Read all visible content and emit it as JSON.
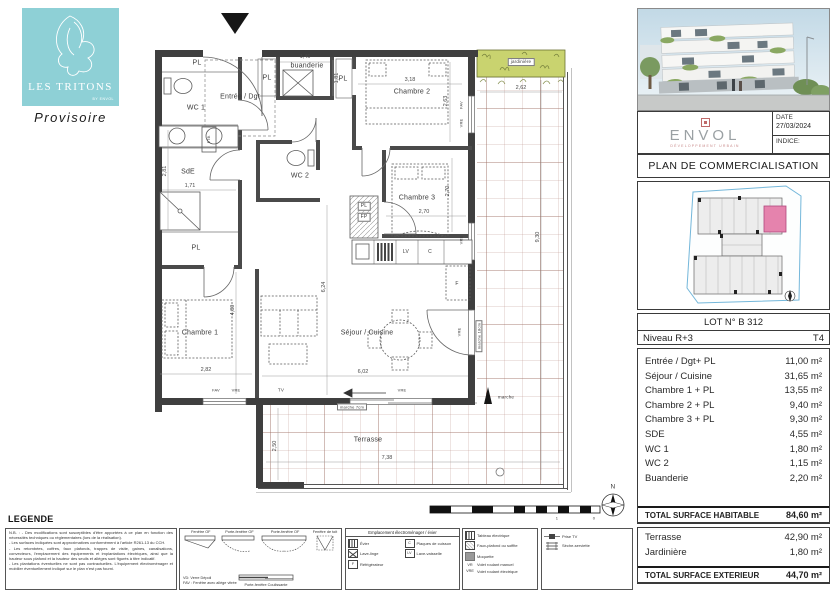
{
  "logo": {
    "title": "LES TRITONS",
    "subtitle": "BY ENVOL",
    "status": "Provisoire"
  },
  "header": {
    "developer_name": "ENVOL",
    "developer_tagline": "DÉVELOPPEMENT URBAIN",
    "date_label": "DATE",
    "date_value": "27/03/2024",
    "indice_label": "INDICE:",
    "doc_title": "PLAN DE COMMERCIALISATION"
  },
  "lot": {
    "number": "LOT N° B 312",
    "level": "Niveau R+3",
    "type": "T4"
  },
  "surfaces": {
    "rooms": [
      {
        "name": "Entrée / Dgt+ PL",
        "area": "11,00 m²"
      },
      {
        "name": "Séjour / Cuisine",
        "area": "31,65 m²"
      },
      {
        "name": "Chambre 1 + PL",
        "area": "13,55 m²"
      },
      {
        "name": "Chambre 2 + PL",
        "area": "9,40 m²"
      },
      {
        "name": "Chambre 3 + PL",
        "area": "9,30 m²"
      },
      {
        "name": "SDE",
        "area": "4,55 m²"
      },
      {
        "name": "WC 1",
        "area": "1,80 m²"
      },
      {
        "name": "WC 2",
        "area": "1,15 m²"
      },
      {
        "name": "Buanderie",
        "area": "2,20 m²"
      }
    ],
    "total_habitable_label": "TOTAL SURFACE HABITABLE",
    "total_habitable_value": "84,60 m²",
    "exterior": [
      {
        "name": "Terrasse",
        "area": "42,90 m²"
      },
      {
        "name": "Jardinière",
        "area": "1,80 m²"
      }
    ],
    "total_exterior_label": "TOTAL SURFACE EXTERIEUR",
    "total_exterior_value": "44,70 m²"
  },
  "plan": {
    "labels": {
      "pl": "PL",
      "fp": "FP",
      "wc1": "WC 1",
      "wc2": "WC 2",
      "sde": "SdE",
      "entree": "Entrée / Dgt",
      "buanderie": "buanderie",
      "chambre1": "Chambre 1",
      "chambre2": "Chambre 2",
      "chambre3": "Chambre 3",
      "sejour": "Séjour / Cuisine",
      "terrasse": "Terrasse",
      "jardiniere": "jardinière",
      "etb": "ETB.",
      "tv": "TV",
      "lv": "LV",
      "c": "C",
      "f": "F",
      "vre": "VRE",
      "fav": "FAV",
      "marche7": "marche 7cm",
      "marche18": "marche 18cm",
      "marche": "marche"
    },
    "dims": {
      "buanderie_w": "1,46",
      "buanderie_h": "1,81",
      "ch2_w": "3,18",
      "ch2_h": "2,63",
      "ch3_w": "2,70",
      "ch3_h": "2,70",
      "sde_h": "2,81",
      "sde_w": "1,71",
      "ch1_w": "2,82",
      "ch1_h": "4,80",
      "sejour_w": "6,02",
      "sejour_h": "6,24",
      "terr_top": "2,62",
      "terr_right_h": "9,30",
      "terr_bottom_w": "7,38",
      "terr_bottom_h": "2,50"
    },
    "compass": "N",
    "scale_ticks": [
      "1",
      "0"
    ]
  },
  "legend": {
    "title": "LEGENDE",
    "nb_lines": [
      "N.B. : - Des modifications sont susceptibles d'être apportées à ce plan en fonction des nécessités techniques ou réglementaires (lors de la réalisation).",
      "- Les surfaces indiquées sont approximatives conformément à l'article R261-13 du CCH.",
      "- Les retombées, coffres, faux plafonds, trappes de visite, gaines, canalisations, convecteurs, l'emplacement des équipements et implantations électriques, ainsi que la hauteur sous plafond et la hauteur des seuils et allèges sont figurés à titre indicatif.",
      "- Les plantations éventuelles ne sont pas contractuelles. L'équipement électroménager et mobilier éventuellement indiqué sur le plan n'est pas fourni."
    ],
    "windows": {
      "w1": "Fenêtre OF",
      "w2": "Porte-fenêtre OF",
      "w3": "Porte-fenêtre OF",
      "w4": "Fenêtre de toit",
      "note1": "VD: Verre Dépoli",
      "note2": "FAV : Fenêtre avec allège vitrée",
      "sliding": "Porte-fenêtre Coulissante"
    },
    "appliances": {
      "header": "Emplacement électroménager / évier",
      "evier": "Évier",
      "lave_linge": "Lave-linge",
      "refrigerateur": "Réfrigérateur",
      "plaques": "Plaques de cuisson",
      "lave_vaisselle": "Lave-vaisselle",
      "ico_c": "C",
      "ico_f": "F",
      "ico_lv": "LV"
    },
    "electric": {
      "tableau": "Tableau électrique",
      "faux_plafond": "Faux-plafond ou soffite",
      "moquette": "Moquette",
      "vr": "VR",
      "vr_label": "Volet roulant manuel",
      "vre": "VRE",
      "vre_label": "Volet roulant électrique"
    },
    "misc": {
      "prise_tv": "Prise TV",
      "prise_tv_ico": "TV",
      "seche": "Sèche-serviette"
    }
  },
  "colors": {
    "logo_teal": "#8ed0d6",
    "jardiniere_green": "#c9d36f",
    "unit_pink": "#e583ad",
    "keyplan_blue": "#74b7da",
    "wall": "#3f3f3f",
    "terrace_line": "#a5705f"
  }
}
